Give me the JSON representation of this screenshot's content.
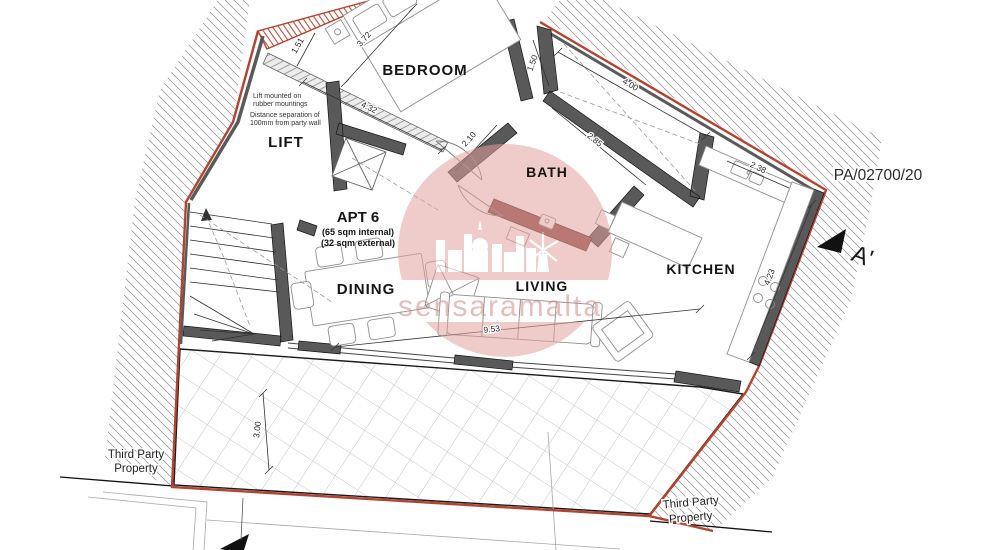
{
  "reference": "PA/02700/20",
  "apartment": {
    "name": "APT 6",
    "area_internal": "(65 sqm internal)",
    "area_external": "(32 sqm external)"
  },
  "rooms": {
    "bedroom": "BEDROOM",
    "lift": "LIFT",
    "bath": "BATH",
    "kitchen": "KITCHEN",
    "dining": "DINING",
    "living": "LIVING"
  },
  "notes": {
    "lift_1": "Lift mounted on",
    "lift_2": "rubber mountings",
    "sep_1": "Distance separation of",
    "sep_2": "100mm from party wall"
  },
  "boundaries": {
    "left_1": "Third Party",
    "left_2": "Property",
    "right_1": "Third Party",
    "right_2": "Property"
  },
  "section": {
    "label": "A'"
  },
  "dimensions": {
    "bedroom_side": "3.72",
    "bedroom_end": "1.51",
    "party_wall": "4.32",
    "shaft_width": "1.50",
    "shaft_length": "4.00",
    "bath_side": "2.10",
    "bath_top": "2.85",
    "kitchen_top": "2.38",
    "kitchen_side": "4.23",
    "living_width": "9.53",
    "terrace_depth": "3.00"
  },
  "watermark": {
    "text": "sensaramalta"
  },
  "colors": {
    "boundary": "#b5432f",
    "wall": "#595959",
    "bath_wall": "#8a4543",
    "watermark": "#e2a39d",
    "watermark_text": "#cf8b85"
  }
}
